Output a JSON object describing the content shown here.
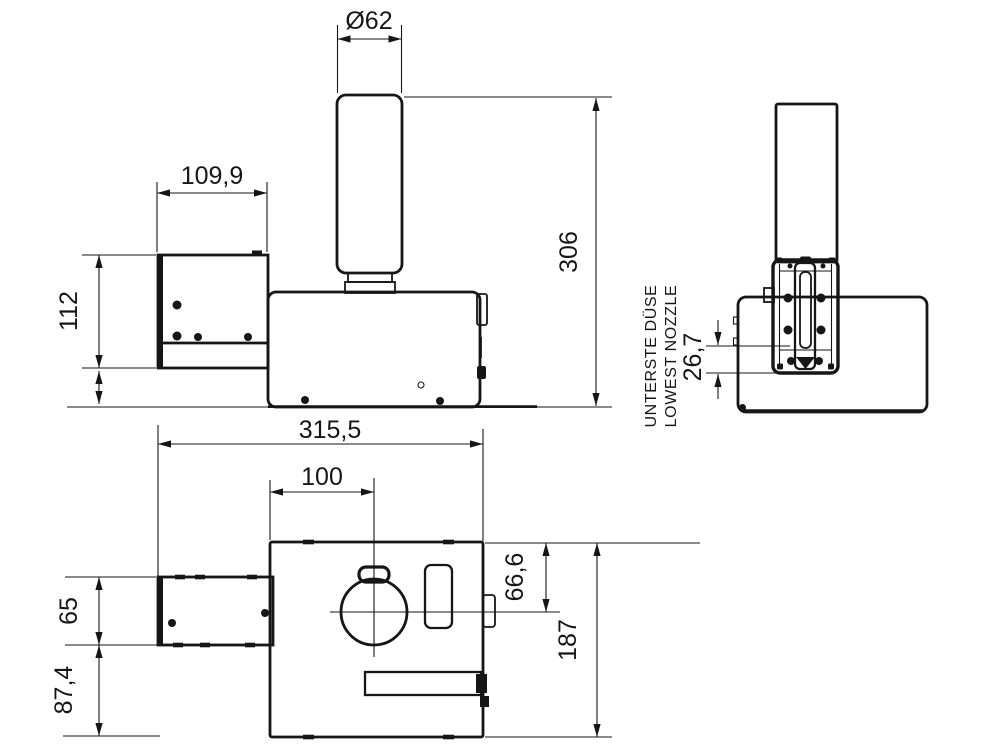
{
  "drawing": {
    "colors": {
      "ink": "#161616",
      "background": "#ffffff"
    },
    "dims": {
      "nozzle_diameter": "Ø62",
      "bracket_width": "109,9",
      "bracket_height": "112",
      "overall_height": "306",
      "overall_length": "315,5",
      "nozzle_axis_offset": "100",
      "bracket_depth": "65",
      "bracket_rear_distance": "87,4",
      "outlet_offset": "66,6",
      "body_depth": "187",
      "lowest_nozzle_offset": "26,7"
    },
    "notes": {
      "lowest_nozzle_de": "UNTERSTE DÜSE",
      "lowest_nozzle_en": "LOWEST NOZZLE"
    }
  }
}
